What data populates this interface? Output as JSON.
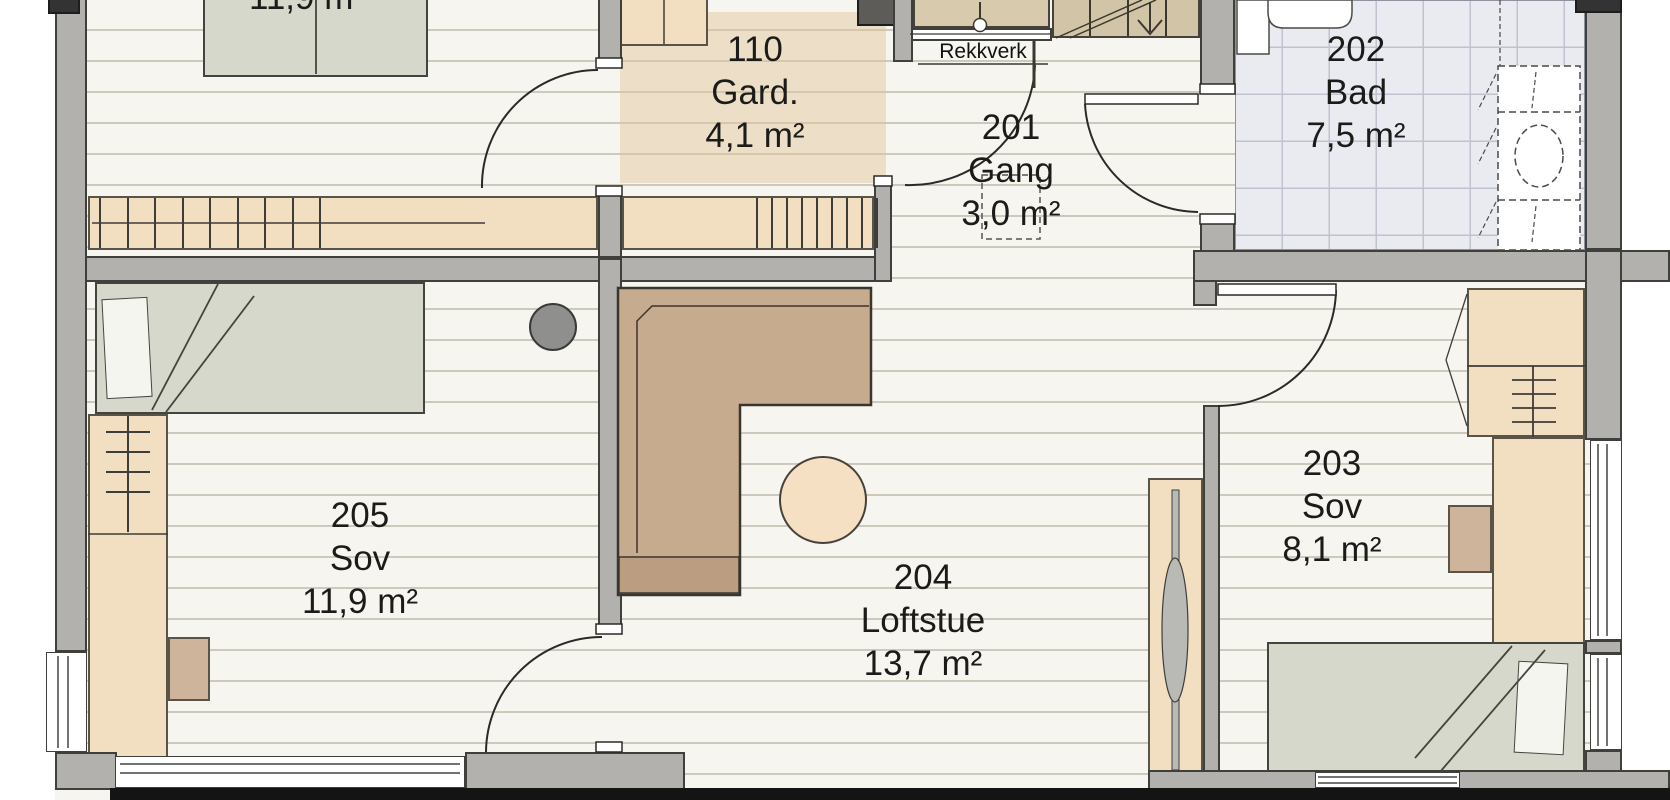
{
  "rooms": {
    "top_left_partial": {
      "area": "11,9 m²"
    },
    "gard": {
      "number": "110",
      "name": "Gard.",
      "area": "4,1 m²"
    },
    "gang": {
      "number": "201",
      "name": "Gang",
      "area": "3,0 m²"
    },
    "bad": {
      "number": "202",
      "name": "Bad",
      "area": "7,5 m²"
    },
    "sov_203": {
      "number": "203",
      "name": "Sov",
      "area": "8,1 m²"
    },
    "loftstue": {
      "number": "204",
      "name": "Loftstue",
      "area": "13,7 m²"
    },
    "sov_205": {
      "number": "205",
      "name": "Sov",
      "area": "11,9 m²"
    }
  },
  "annotations": {
    "railing_label": "Rekkverk"
  },
  "colors": {
    "floor": "#f7f5ef",
    "wall": "#b2b1ae",
    "wood_furniture": "#f2dfc2",
    "bed": "#d5d8ca",
    "sofa": "#c7ab8e",
    "bath_tile": "#e9ebf1",
    "gard_highlight": "#e0c496",
    "stair": "#d2c5a7",
    "pouf": "#f6e0c3"
  }
}
